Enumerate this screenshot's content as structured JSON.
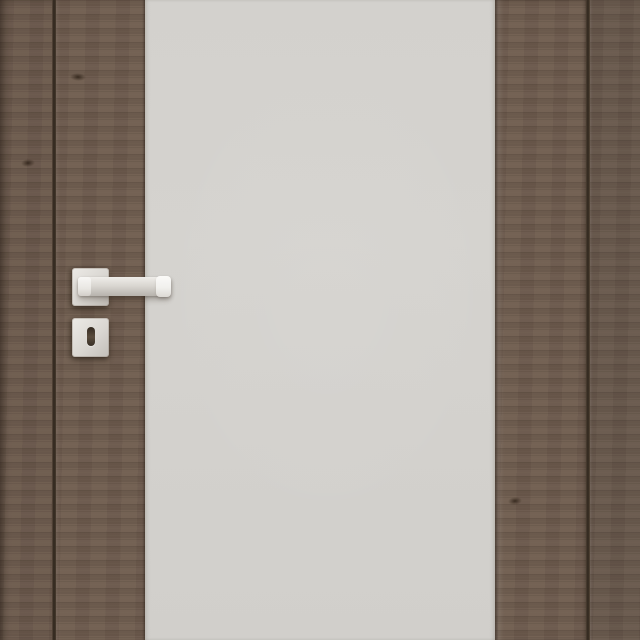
{
  "image": {
    "kind": "product-photo",
    "subject": "Closed interior wooden door with full-height frosted glass centre panel, satin-chrome square-rose lever handle and square keyhole escutcheon, set in a matching dark wood frame",
    "parts": {
      "frame_left": "door frame casing (left)",
      "frame_gap_left": "shadow gap between left casing and door leaf",
      "stile_left": "left wood stile of door leaf",
      "glass_panel": "frosted glass centre panel",
      "stile_right": "right wood stile of door leaf",
      "frame_gap_right": "shadow gap between door leaf and right casing",
      "frame_right": "door frame casing (right)",
      "handle_rose": "square rose plate of lever handle",
      "handle_lever": "straight lever handle, satin chrome",
      "handle_neck": "lever spindle neck",
      "handle_end_cap": "polished end cap of lever",
      "escutcheon": "square keyhole escutcheon plate",
      "keyhole": "keyhole slot",
      "knot_left_casing": "wood grain knot on left casing",
      "knot_left_stile": "wood grain knot on left stile",
      "knot_right_stile": "wood grain knot on right stile"
    },
    "colors": {
      "wood": "#6e5c4e",
      "wood_seam_shadow": "#32291f",
      "wood_highlight": "#82705f",
      "glass": "#d3d1cd",
      "metal_light": "#f5f4f1",
      "metal_mid": "#d8d5d0",
      "metal_dark": "#b7b3ad",
      "keyhole": "#3c332a"
    }
  }
}
